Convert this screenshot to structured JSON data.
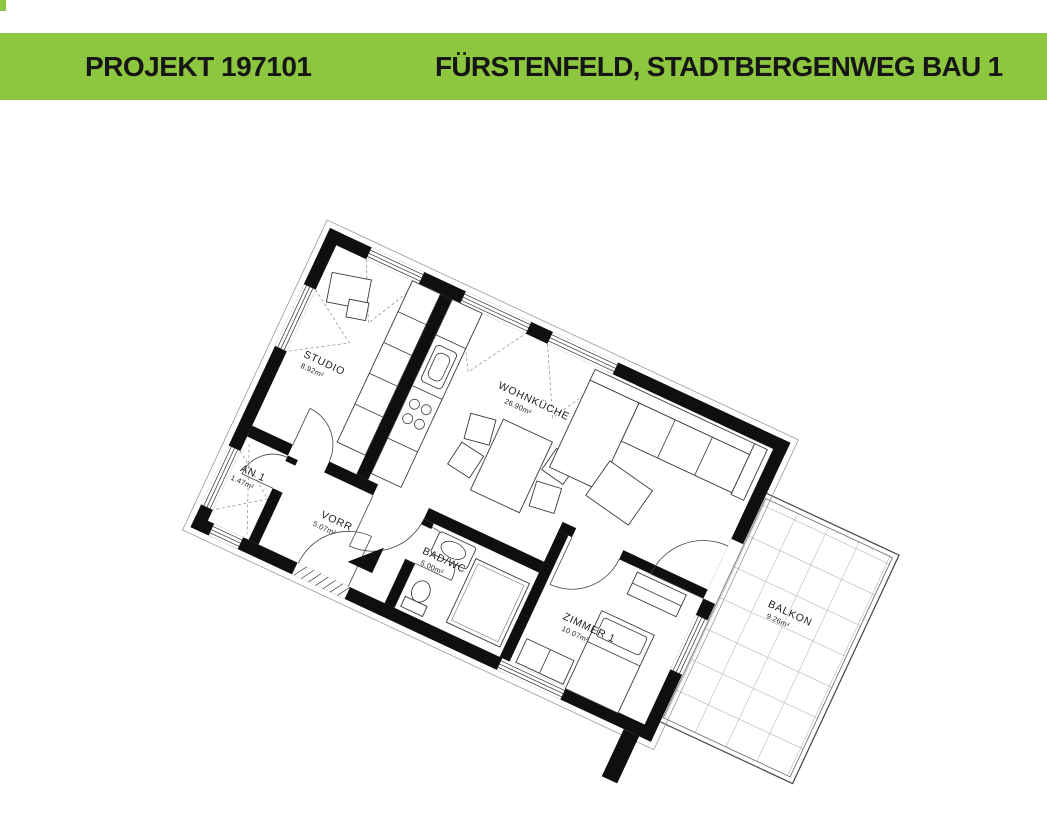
{
  "header": {
    "project_label": "PROJEKT 197101",
    "title": "FÜRSTENFELD, STADTBERGENWEG BAU 1",
    "bar_color": "#8dc63f",
    "text_color": "#161616"
  },
  "floorplan": {
    "rotation_deg": 25,
    "rooms": [
      {
        "name": "STUDIO",
        "area": "8.92m²"
      },
      {
        "name": "WOHNKÜCHE",
        "area": "26.90m²"
      },
      {
        "name": "AN 1",
        "area": "1.47m²"
      },
      {
        "name": "VORR",
        "area": "5.07m²"
      },
      {
        "name": "BAD/WC",
        "area": "5.00m²"
      },
      {
        "name": "ZIMMER 1",
        "area": "10.07m²"
      },
      {
        "name": "BALKON",
        "area": "9.26m²"
      }
    ]
  }
}
